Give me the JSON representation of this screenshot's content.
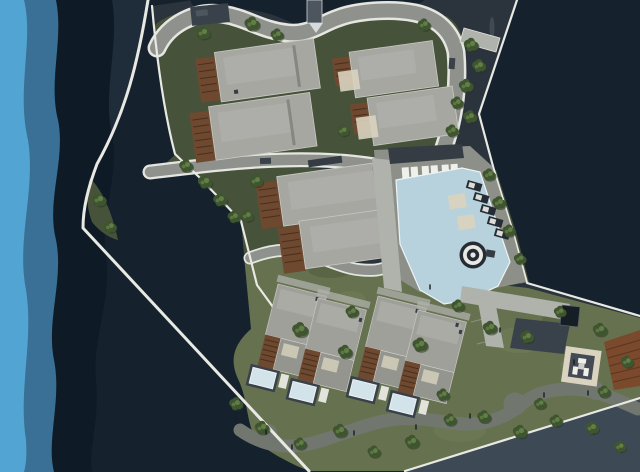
{
  "scene": {
    "type": "architectural-site-plan-rendering",
    "view": "top-down master plan of a waterfront residential resort",
    "visible_text": []
  },
  "palette": {
    "waterDeep": "#15222e",
    "waterShore": "#1f2c39",
    "bandNavy": "#0e1b27",
    "bandMid": "#3a7095",
    "bandLight": "#52a5d3",
    "channel": "#3d4a56",
    "seawall": "#e9e9e3",
    "asphalt": "#2b333c",
    "roadFill": "#8f918d",
    "roadEdge": "#e6e6e1",
    "walkLight": "#b0b2ac",
    "deckGray": "#8d9089",
    "lane": "#39414b",
    "lawn": "#47523a",
    "lawnLight": "#66724f",
    "lawnPatch": "#76815c",
    "footpath": "#71776f",
    "roofLight": "#a7a7a2",
    "roofHi": "#b4b4af",
    "roofVilla": "#a0a09b",
    "roofEdge": "#cdcdc8",
    "deckWood": "#6e482f",
    "deckSlat": "#46301f",
    "terrace": "#93958e",
    "beige": "#d9d3bf",
    "pergola": "#353c44",
    "poolWater": "#b7d2dd",
    "poolRim": "#eef3f4",
    "villaPool": "#d2e3e9",
    "pond": "#151d25",
    "woodRed": "#7b492c",
    "loungerDark": "#262c33",
    "white": "#f0f0ea",
    "treeBase": "#3f5530",
    "treeLight": "#68854a",
    "treeShadow": "#263420",
    "person": "#171c21",
    "pierGray": "#4d555f",
    "carLight": "#c6cacc",
    "carDark": "#39414a"
  },
  "features": {
    "water": [
      "open-water",
      "wave-bands-left",
      "inner-cove",
      "bottom-channel"
    ],
    "edges": [
      "outer-seawall",
      "inner-quay-wall",
      "right-coast",
      "bottom-right-coast"
    ],
    "circulation": [
      "entry-road",
      "cross-road",
      "winding-lane",
      "footpath",
      "access-lane",
      "boat-pier"
    ],
    "buildings": {
      "apartment_blocks": 6,
      "villas": 4
    },
    "amenities": [
      "swimming-pool",
      "spa-circle",
      "sun-loungers",
      "pool-pergola",
      "in-pool-platforms",
      "reflecting-pond",
      "bbq-pavilion",
      "waterfront-wood-deck",
      "waterfront-terrace"
    ],
    "landscape": [
      "lawns",
      "trees",
      "corner-bank",
      "pedestrians",
      "cars"
    ]
  }
}
